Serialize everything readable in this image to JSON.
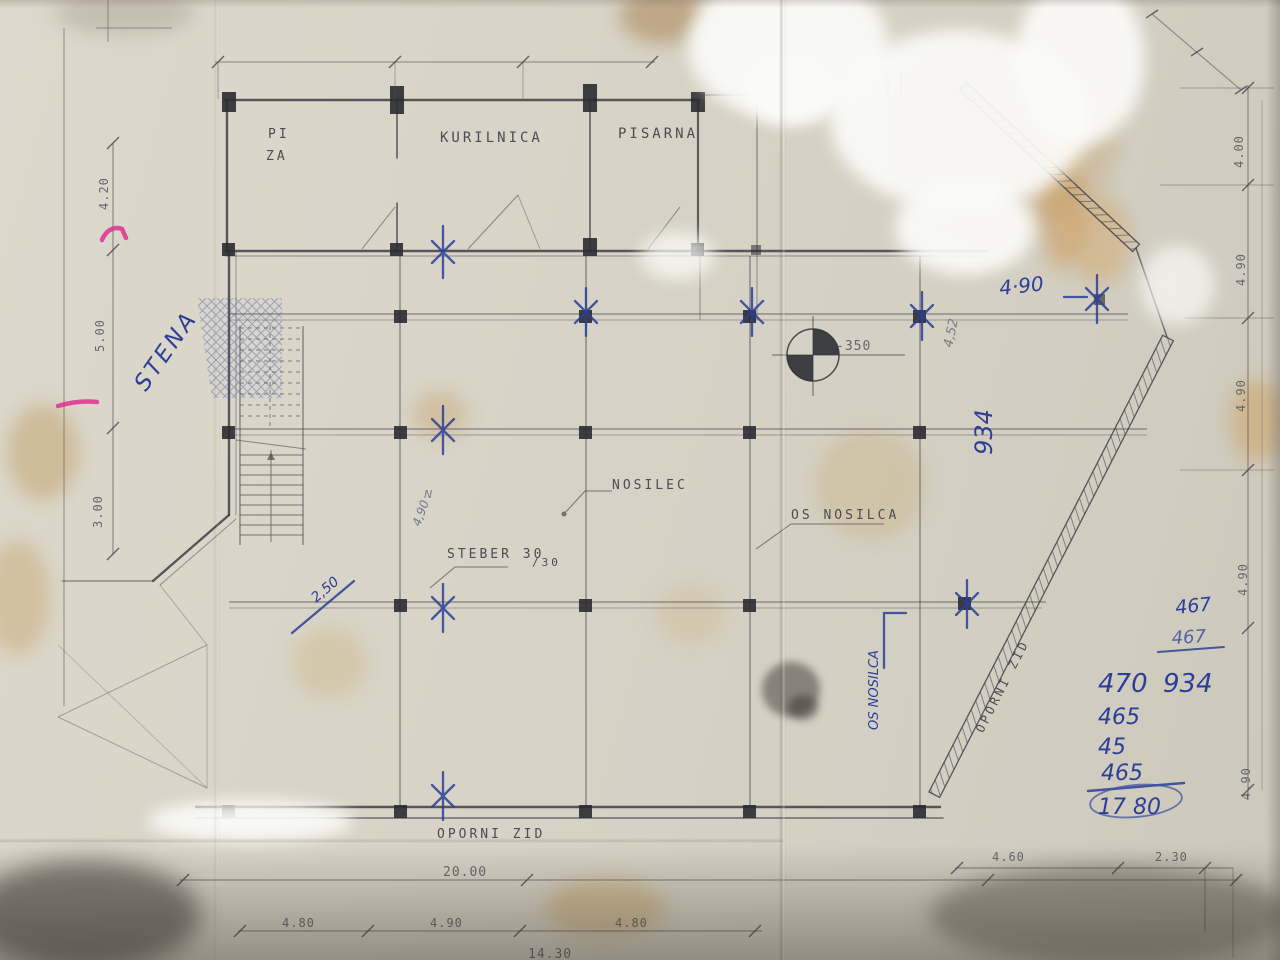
{
  "rooms": {
    "room1_line1": "PI",
    "room1_line2": "ZA",
    "room2": "KURILNICA",
    "room3": "PISARNA"
  },
  "plan_labels": {
    "nosilec": "NOSILEC",
    "os_nosilca": "OS NOSILCA",
    "steber": "STEBER 30",
    "steber_size": "/30",
    "oporni_zid_bottom": "OPORNI ZID",
    "oporni_zid_diagonal": "OPORNI ZID",
    "level_mark": "-350"
  },
  "dimensions": {
    "left": [
      "4.20",
      "5.00",
      "3.00"
    ],
    "right": [
      "4.00",
      "4.90",
      "4.90",
      "4.90",
      "4.90"
    ],
    "bottom_total": "20.00",
    "bottom_segments": [
      "4.80",
      "4.90",
      "4.80"
    ],
    "bottom_clipped": "14.30",
    "bottom_right_segments": [
      "4.60",
      "2.30"
    ]
  },
  "handwritten": {
    "stena": "STENA",
    "dim_490": "4·90",
    "dim_934": "934",
    "dim_452": "4,52",
    "dim_250": "2,50",
    "n_mark": "N",
    "dim_490_small": "4,90",
    "os_nosilca_vertical": "OS NOSILCA",
    "calc_right_add1": "467",
    "calc_right_add2": "467",
    "calc_right_sum": "934",
    "calc_left_items": [
      "470",
      "465",
      "45",
      "465"
    ],
    "calc_total": "17 80"
  }
}
